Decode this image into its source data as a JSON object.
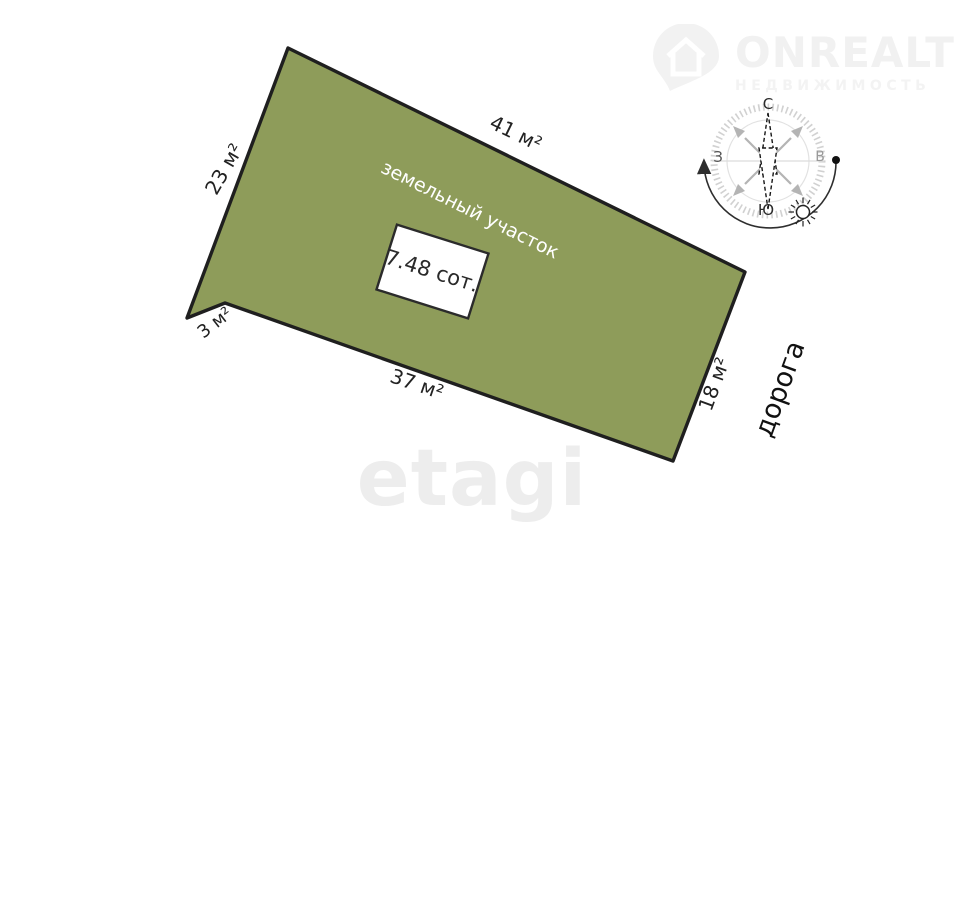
{
  "brand": {
    "name": "ONREALT",
    "subtitle": "НЕДВИЖИМОСТЬ"
  },
  "agency_watermark": "etagi",
  "plot": {
    "type_label": "земельный участок",
    "area": "7.48 сот.",
    "edge_labels": {
      "top": "41 м²",
      "left": "23 м²",
      "bottom_left": "3 м²",
      "bottom": "37 м²",
      "right": "18 м²"
    },
    "fill_color": "#8e9c5a",
    "outline_color": "#1f1f1f"
  },
  "road_label": "дорога",
  "compass": {
    "north": "С",
    "south": "Ю",
    "west": "З",
    "east": "В"
  }
}
